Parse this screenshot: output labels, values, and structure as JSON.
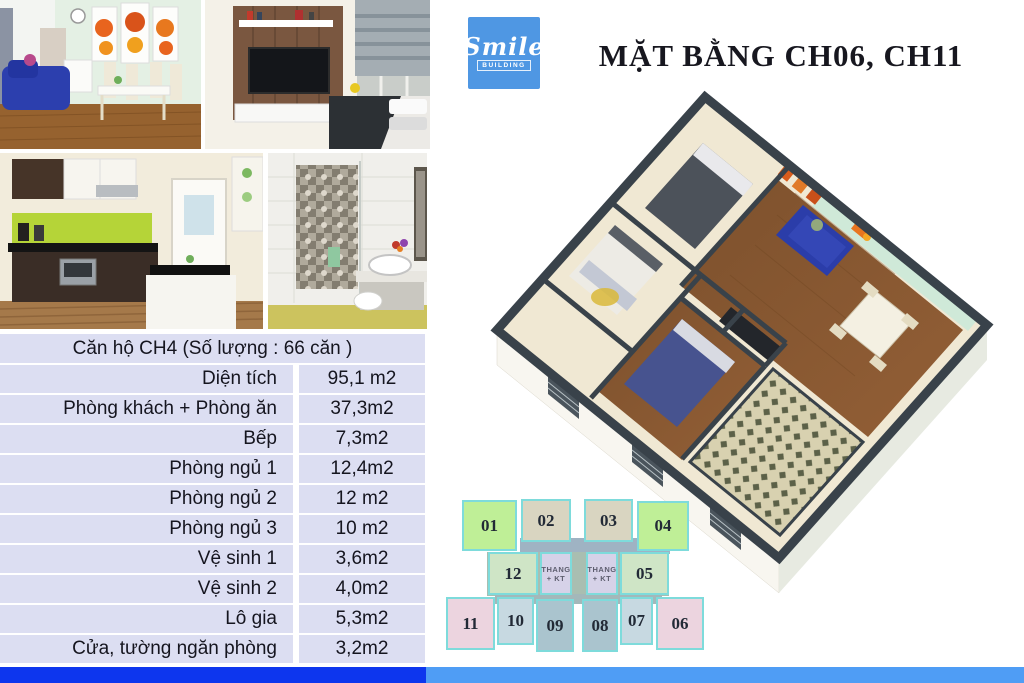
{
  "logo": {
    "name": "Smile",
    "sub": "BUILDING",
    "color": "#4f97e3"
  },
  "title": "MẶT BẰNG CH06, CH11",
  "media": {
    "photo1": "living-dining-room-photo",
    "photo2": "bedroom-tv-photo",
    "photo3": "kitchen-photo",
    "photo4": "bathroom-photo",
    "floorplan": "3d-floorplan-render"
  },
  "spec_table": {
    "header": "Căn hộ CH4 (Số lượng : 66 căn )",
    "rows": [
      {
        "label": "Diện tích",
        "value": "95,1 m2"
      },
      {
        "label": "Phòng khách + Phòng ăn",
        "value": "37,3m2"
      },
      {
        "label": "Bếp",
        "value": "7,3m2"
      },
      {
        "label": "Phòng ngủ 1",
        "value": "12,4m2"
      },
      {
        "label": "Phòng ngủ 2",
        "value": "12 m2"
      },
      {
        "label": "Phòng ngủ 3",
        "value": "10 m2"
      },
      {
        "label": "Vệ sinh 1",
        "value": "3,6m2"
      },
      {
        "label": "Vệ sinh 2",
        "value": "4,0m2"
      },
      {
        "label": "Lô gia",
        "value": "5,3m2"
      },
      {
        "label": "Cửa, tường ngăn phòng",
        "value": "3,2m2"
      }
    ]
  },
  "diagram": {
    "border_color": "#7edbdb",
    "stair_line1": "THANG",
    "stair_line2": "+ KT",
    "units": [
      {
        "id": "01",
        "color": "#bfef97"
      },
      {
        "id": "02",
        "color": "#d9d5c1"
      },
      {
        "id": "03",
        "color": "#d9d5c1"
      },
      {
        "id": "04",
        "color": "#bfef97"
      },
      {
        "id": "12",
        "color": "#cfe5c6"
      },
      {
        "id": "05",
        "color": "#cfe5c6"
      },
      {
        "id": "11",
        "color": "#ecd4df"
      },
      {
        "id": "10",
        "color": "#c7d9e1"
      },
      {
        "id": "09",
        "color": "#aac4ce"
      },
      {
        "id": "08",
        "color": "#aac4ce"
      },
      {
        "id": "07",
        "color": "#c7d9e1"
      },
      {
        "id": "06",
        "color": "#ecd4df"
      }
    ]
  },
  "footer": {
    "left_color": "#0d36ee",
    "right_color": "#4f9df5"
  }
}
